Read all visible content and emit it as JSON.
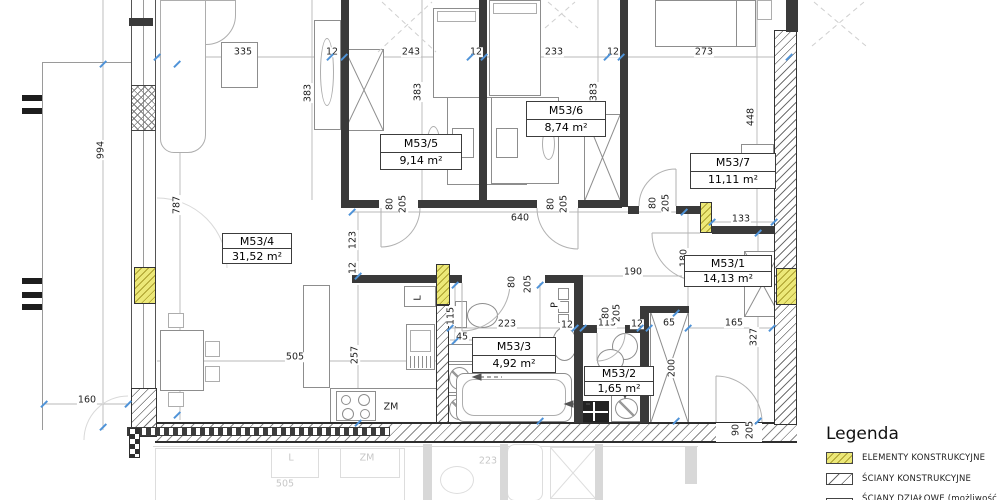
{
  "legend": {
    "title": "Legenda",
    "items": [
      {
        "swatch": "yellow-hatch",
        "label": "ELEMENTY KONSTRUKCYJNE"
      },
      {
        "swatch": "diagonal-hatch",
        "label": "ŚCIANY KONSTRUKCYJNE"
      },
      {
        "swatch": "partition",
        "label": "ŚCIANY DZIAŁOWE (możliwość aranżacji)"
      }
    ]
  },
  "rooms": [
    {
      "name": "M53/4",
      "area": "31,52 m²",
      "x": 222,
      "y": 233,
      "w": 70,
      "h": 31
    },
    {
      "name": "M53/5",
      "area": "9,14 m²",
      "x": 380,
      "y": 134,
      "w": 82,
      "h": 36
    },
    {
      "name": "M53/6",
      "area": "8,74 m²",
      "x": 526,
      "y": 101,
      "w": 80,
      "h": 36
    },
    {
      "name": "M53/7",
      "area": "11,11 m²",
      "x": 690,
      "y": 153,
      "w": 86,
      "h": 36
    },
    {
      "name": "M53/1",
      "area": "14,13 m²",
      "x": 684,
      "y": 255,
      "w": 88,
      "h": 32
    },
    {
      "name": "M53/3",
      "area": "4,92 m²",
      "x": 472,
      "y": 337,
      "w": 84,
      "h": 36
    },
    {
      "name": "M53/2",
      "area": "1,65 m²",
      "x": 584,
      "y": 366,
      "w": 70,
      "h": 30
    }
  ],
  "dims": [
    [
      "335",
      243,
      52,
      0
    ],
    [
      "12",
      332,
      52,
      0
    ],
    [
      "243",
      411,
      52,
      0
    ],
    [
      "12",
      476,
      52,
      0
    ],
    [
      "233",
      554,
      52,
      0
    ],
    [
      "12",
      613,
      52,
      0
    ],
    [
      "273",
      704,
      52,
      0
    ],
    [
      "994",
      101,
      150,
      1
    ],
    [
      "787",
      177,
      205,
      1
    ],
    [
      "383",
      308,
      93,
      1
    ],
    [
      "383",
      418,
      92,
      1
    ],
    [
      "383",
      594,
      92,
      1
    ],
    [
      "448",
      751,
      117,
      1
    ],
    [
      "80",
      390,
      204,
      1
    ],
    [
      "205",
      403,
      204,
      1
    ],
    [
      "640",
      520,
      218,
      0
    ],
    [
      "80",
      551,
      204,
      1
    ],
    [
      "205",
      564,
      204,
      1
    ],
    [
      "80",
      653,
      203,
      1
    ],
    [
      "205",
      666,
      203,
      1
    ],
    [
      "133",
      741,
      219,
      0
    ],
    [
      "123",
      353,
      240,
      1
    ],
    [
      "12",
      353,
      268,
      1
    ],
    [
      "180",
      684,
      258,
      1
    ],
    [
      "190",
      633,
      272,
      0
    ],
    [
      "80",
      512,
      282,
      1
    ],
    [
      "205",
      528,
      284,
      1
    ],
    [
      "115",
      451,
      316,
      1
    ],
    [
      "45",
      462,
      337,
      0
    ],
    [
      "223",
      507,
      324,
      0
    ],
    [
      "12",
      567,
      325,
      0
    ],
    [
      "113",
      607,
      323,
      0
    ],
    [
      "12",
      637,
      324,
      0
    ],
    [
      "65",
      669,
      323,
      0
    ],
    [
      "165",
      734,
      323,
      0
    ],
    [
      "327",
      754,
      337,
      1
    ],
    [
      "80",
      606,
      313,
      1
    ],
    [
      "205",
      617,
      313,
      1
    ],
    [
      "256",
      536,
      357,
      1
    ],
    [
      "257",
      355,
      355,
      1
    ],
    [
      "505",
      295,
      357,
      0
    ],
    [
      "200",
      672,
      368,
      1
    ],
    [
      "160",
      87,
      400,
      0
    ],
    [
      "90",
      736,
      430,
      1
    ],
    [
      "205",
      750,
      430,
      1
    ]
  ],
  "unit_labels": [
    [
      "ZM",
      391,
      407,
      0
    ],
    [
      "L",
      418,
      298,
      1
    ],
    [
      "P",
      555,
      305,
      1
    ]
  ],
  "ticks": [
    [
      157,
      57
    ],
    [
      330,
      57
    ],
    [
      344,
      57
    ],
    [
      470,
      57
    ],
    [
      484,
      57
    ],
    [
      607,
      57
    ],
    [
      621,
      57
    ],
    [
      789,
      57
    ],
    [
      103,
      64
    ],
    [
      103,
      427
    ],
    [
      177,
      64
    ],
    [
      177,
      415
    ],
    [
      44,
      404
    ],
    [
      128,
      404
    ],
    [
      352,
      212
    ],
    [
      684,
      212
    ],
    [
      358,
      276
    ],
    [
      358,
      423
    ],
    [
      540,
      285
    ],
    [
      540,
      421
    ],
    [
      450,
      328
    ],
    [
      575,
      328
    ],
    [
      583,
      328
    ],
    [
      640,
      328
    ],
    [
      649,
      328
    ],
    [
      688,
      328
    ],
    [
      772,
      328
    ],
    [
      676,
      313
    ],
    [
      676,
      421
    ],
    [
      712,
      222
    ],
    [
      774,
      222
    ],
    [
      758,
      233
    ],
    [
      758,
      421
    ],
    [
      455,
      285
    ],
    [
      455,
      341
    ]
  ],
  "reflection_texts": [
    [
      "L",
      166,
      14
    ],
    [
      "ZM",
      242,
      14
    ],
    [
      "505",
      160,
      40
    ],
    [
      "223",
      363,
      17
    ]
  ],
  "colors": {
    "structural_yellow": "#ece878",
    "wall_dark": "#3a3a3a",
    "dim_tick_blue": "#4f93d8"
  }
}
